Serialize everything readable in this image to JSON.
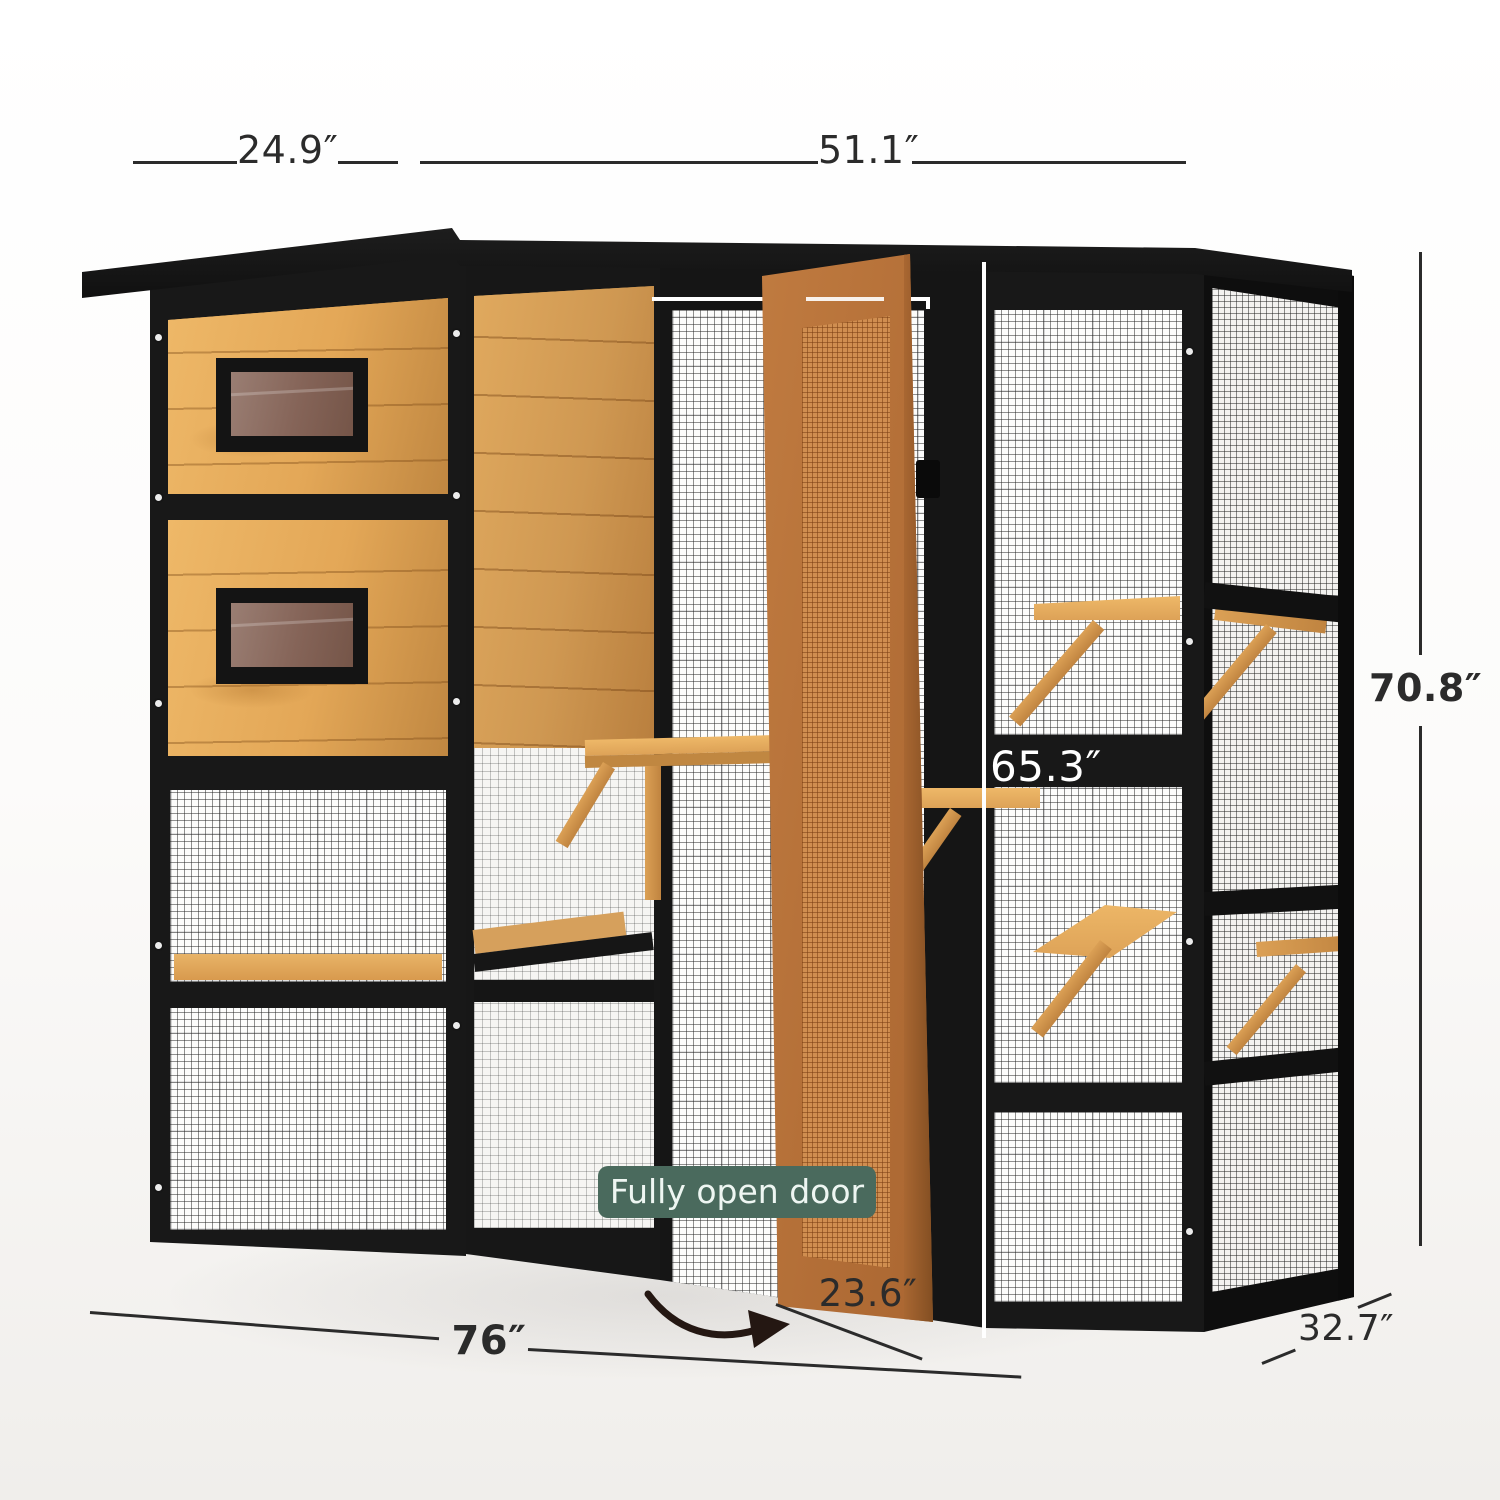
{
  "product": {
    "name": "catio-cat-enclosure-render",
    "badge": {
      "label": "Fully open door"
    },
    "annotations": {
      "top_left_width": "24.9″",
      "top_right_width": "51.1″",
      "overall_height": "70.8″",
      "opening_height": "65.3″",
      "overall_width": "76″",
      "door_width": "23.6″",
      "overall_depth": "32.7″"
    },
    "icons": {
      "door_swing_arrow": "curved-arrow-right"
    }
  },
  "colors": {
    "frame": "#181818",
    "wood": "#e3a757",
    "wood_dark": "#c08741",
    "wood_light": "#eeb868",
    "door": "#b5713a",
    "door_mesh": "#d08e50",
    "badge_bg": "#4a6a5d",
    "badge_fg": "#eef6f2",
    "annotation": "#2b2b2b",
    "glass": "#8d6f64"
  }
}
